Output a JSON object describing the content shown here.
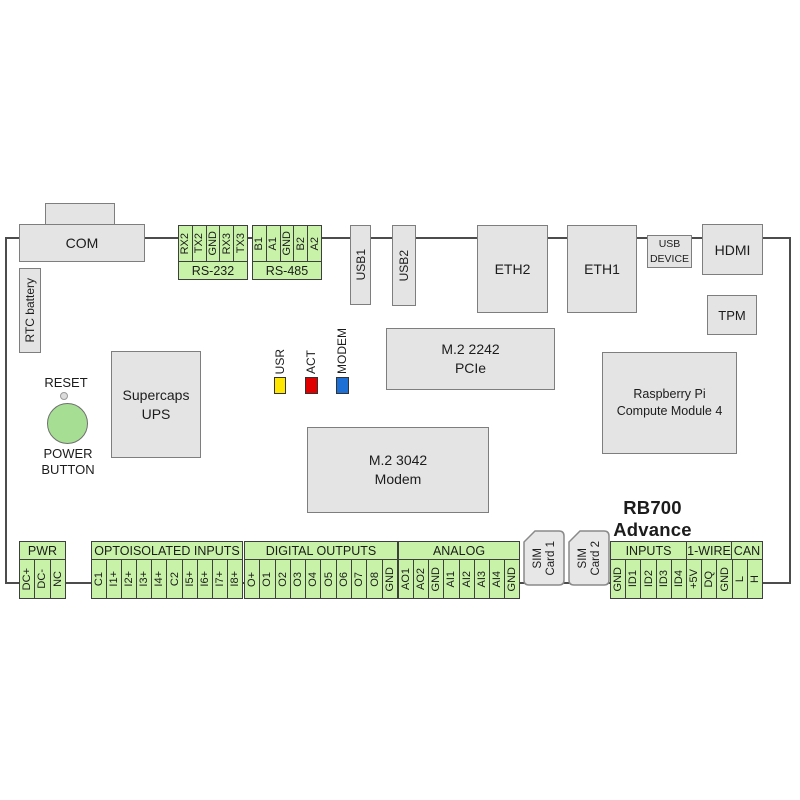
{
  "title": "RB700 Advance",
  "colors": {
    "terminal_green": "#c7f2a7",
    "led_usr": "#ffe600",
    "led_act": "#e10000",
    "led_modem": "#1d6fd5",
    "power_button_green": "#a6df93"
  },
  "top": {
    "com": "COM",
    "rtc_battery": "RTC battery",
    "rs232": {
      "label": "RS-232",
      "pins": [
        "RX2",
        "TX2",
        "GND",
        "RX3",
        "TX3"
      ]
    },
    "rs485": {
      "label": "RS-485",
      "pins": [
        "B1",
        "A1",
        "GND",
        "B2",
        "A2"
      ]
    },
    "usb1": "USB1",
    "usb2": "USB2",
    "eth2": "ETH2",
    "eth1": "ETH1",
    "usb_device": {
      "line1": "USB",
      "line2": "DEVICE"
    },
    "hdmi": "HDMI",
    "tpm": "TPM"
  },
  "middle": {
    "reset": "RESET",
    "power_button": {
      "line1": "POWER",
      "line2": "BUTTON"
    },
    "supercaps": {
      "line1": "Supercaps",
      "line2": "UPS"
    },
    "leds": [
      {
        "label": "USR"
      },
      {
        "label": "ACT"
      },
      {
        "label": "MODEM"
      }
    ],
    "m2_2242": {
      "line1": "M.2 2242",
      "line2": "PCIe"
    },
    "m2_3042": {
      "line1": "M.2 3042",
      "line2": "Modem"
    },
    "cm4": {
      "line1": "Raspberry Pi",
      "line2": "Compute Module 4"
    }
  },
  "bottom": {
    "pwr": {
      "label": "PWR",
      "pins": [
        "DC+",
        "DC-",
        "NC"
      ]
    },
    "opto": {
      "label": "OPTOISOLATED INPUTS",
      "pins": [
        "C1",
        "I1+",
        "I2+",
        "I3+",
        "I4+",
        "C2",
        "I5+",
        "I6+",
        "I7+",
        "I8+"
      ]
    },
    "digital": {
      "label": "DIGITAL OUTPUTS",
      "pins": [
        "O+",
        "O1",
        "O2",
        "O3",
        "O4",
        "O5",
        "O6",
        "O7",
        "O8",
        "GND"
      ]
    },
    "analog": {
      "label": "ANALOG",
      "pins": [
        "AO1",
        "AO2",
        "GND",
        "AI1",
        "AI2",
        "AI3",
        "AI4",
        "GND"
      ]
    },
    "sim1": {
      "line1": "SIM",
      "line2": "Card 1"
    },
    "sim2": {
      "line1": "SIM",
      "line2": "Card 2"
    },
    "io": {
      "inputs": {
        "label": "INPUTS",
        "pins": [
          "GND",
          "ID1",
          "ID2",
          "ID3",
          "ID4"
        ]
      },
      "onewire": {
        "label": "1-WIRE",
        "pins": [
          "+5V",
          "DQ",
          "GND"
        ]
      },
      "can": {
        "label": "CAN",
        "pins": [
          "L",
          "H"
        ]
      }
    }
  }
}
